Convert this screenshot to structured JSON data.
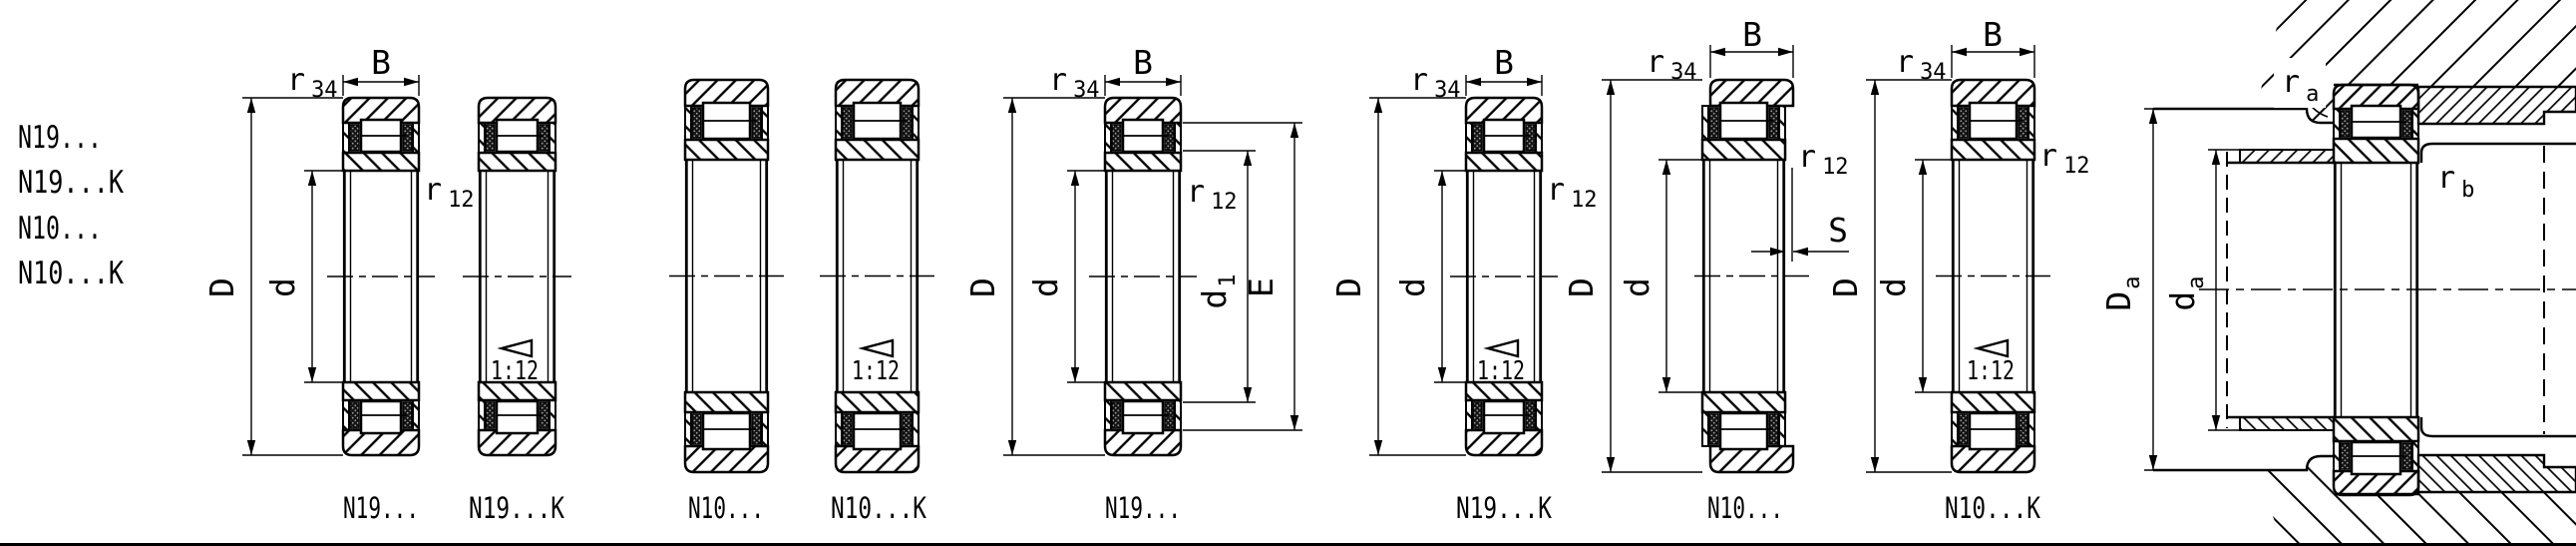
{
  "drawing": {
    "title": "Cylindrical roller bearing dimension drawing",
    "series_list": [
      "N19...",
      "N19...K",
      "N10...",
      "N10...K"
    ],
    "figures": [
      {
        "label": "N19...",
        "tapered": false
      },
      {
        "label": "N19...K",
        "tapered": true
      },
      {
        "label": "N10...",
        "tapered": false
      },
      {
        "label": "N10...K",
        "tapered": true
      },
      {
        "label": "N19...",
        "tapered": false
      },
      {
        "label": "N19...K",
        "tapered": true
      },
      {
        "label": "N10...",
        "tapered": false
      },
      {
        "label": "N10...K",
        "tapered": true
      }
    ],
    "dimensions": {
      "width": "B",
      "outer_diameter": "D",
      "bore_diameter": "d",
      "radius_letter": "r",
      "radius_sub_34": "34",
      "radius_sub_12": "12",
      "sub_1": "1",
      "outer_raceway_diameter": "E",
      "axial_displacement": "S",
      "taper_ratio": "1:12",
      "sub_a": "a",
      "sub_b": "b"
    },
    "colors": {
      "line": "#000000",
      "background": "#ffffff"
    }
  }
}
